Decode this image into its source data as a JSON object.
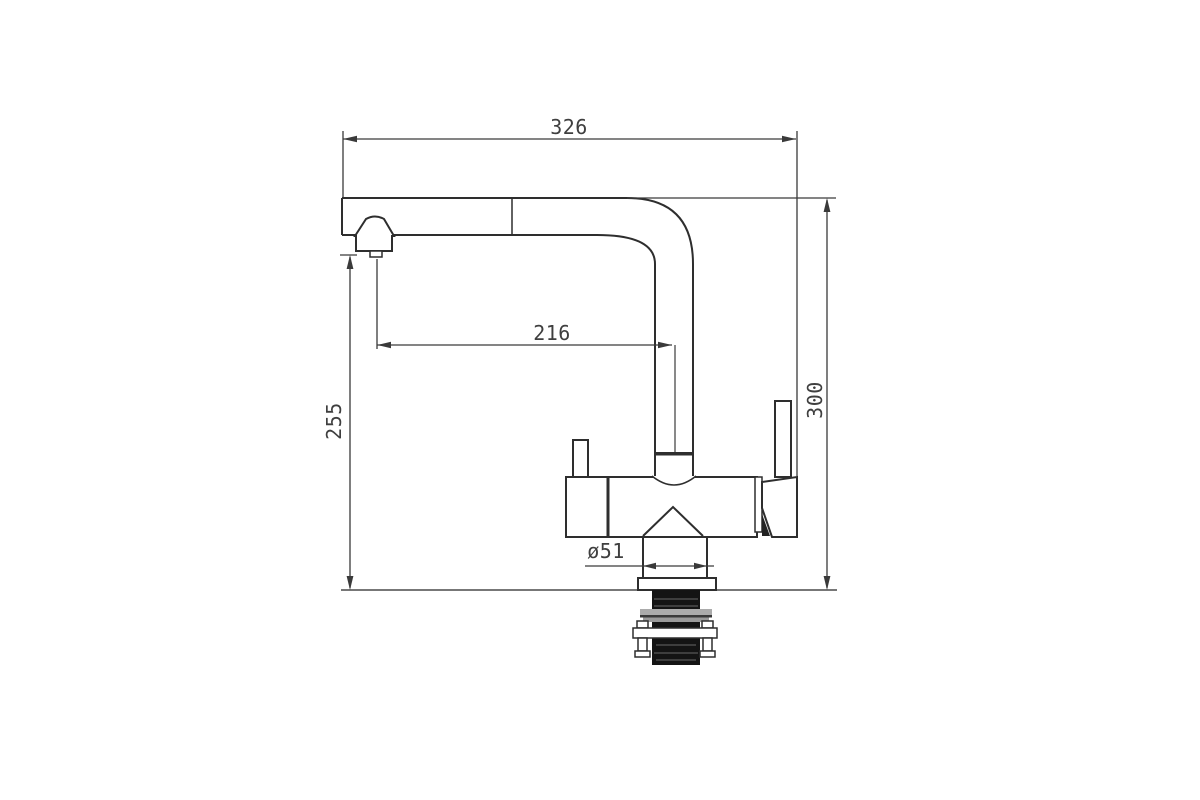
{
  "drawing": {
    "title": "kitchen-faucet-technical-drawing",
    "labels": {
      "width_total": "326",
      "spout_reach": "216",
      "spout_height": "255",
      "height_total": "300",
      "base_diameter": "ø51"
    },
    "colors": {
      "line": "#2e2e2e",
      "dimension_line": "#3a3a3a",
      "text": "#3f3f3f",
      "background": "#ffffff",
      "shank_fill": "#141414",
      "nut_fill": "#ababab"
    }
  }
}
